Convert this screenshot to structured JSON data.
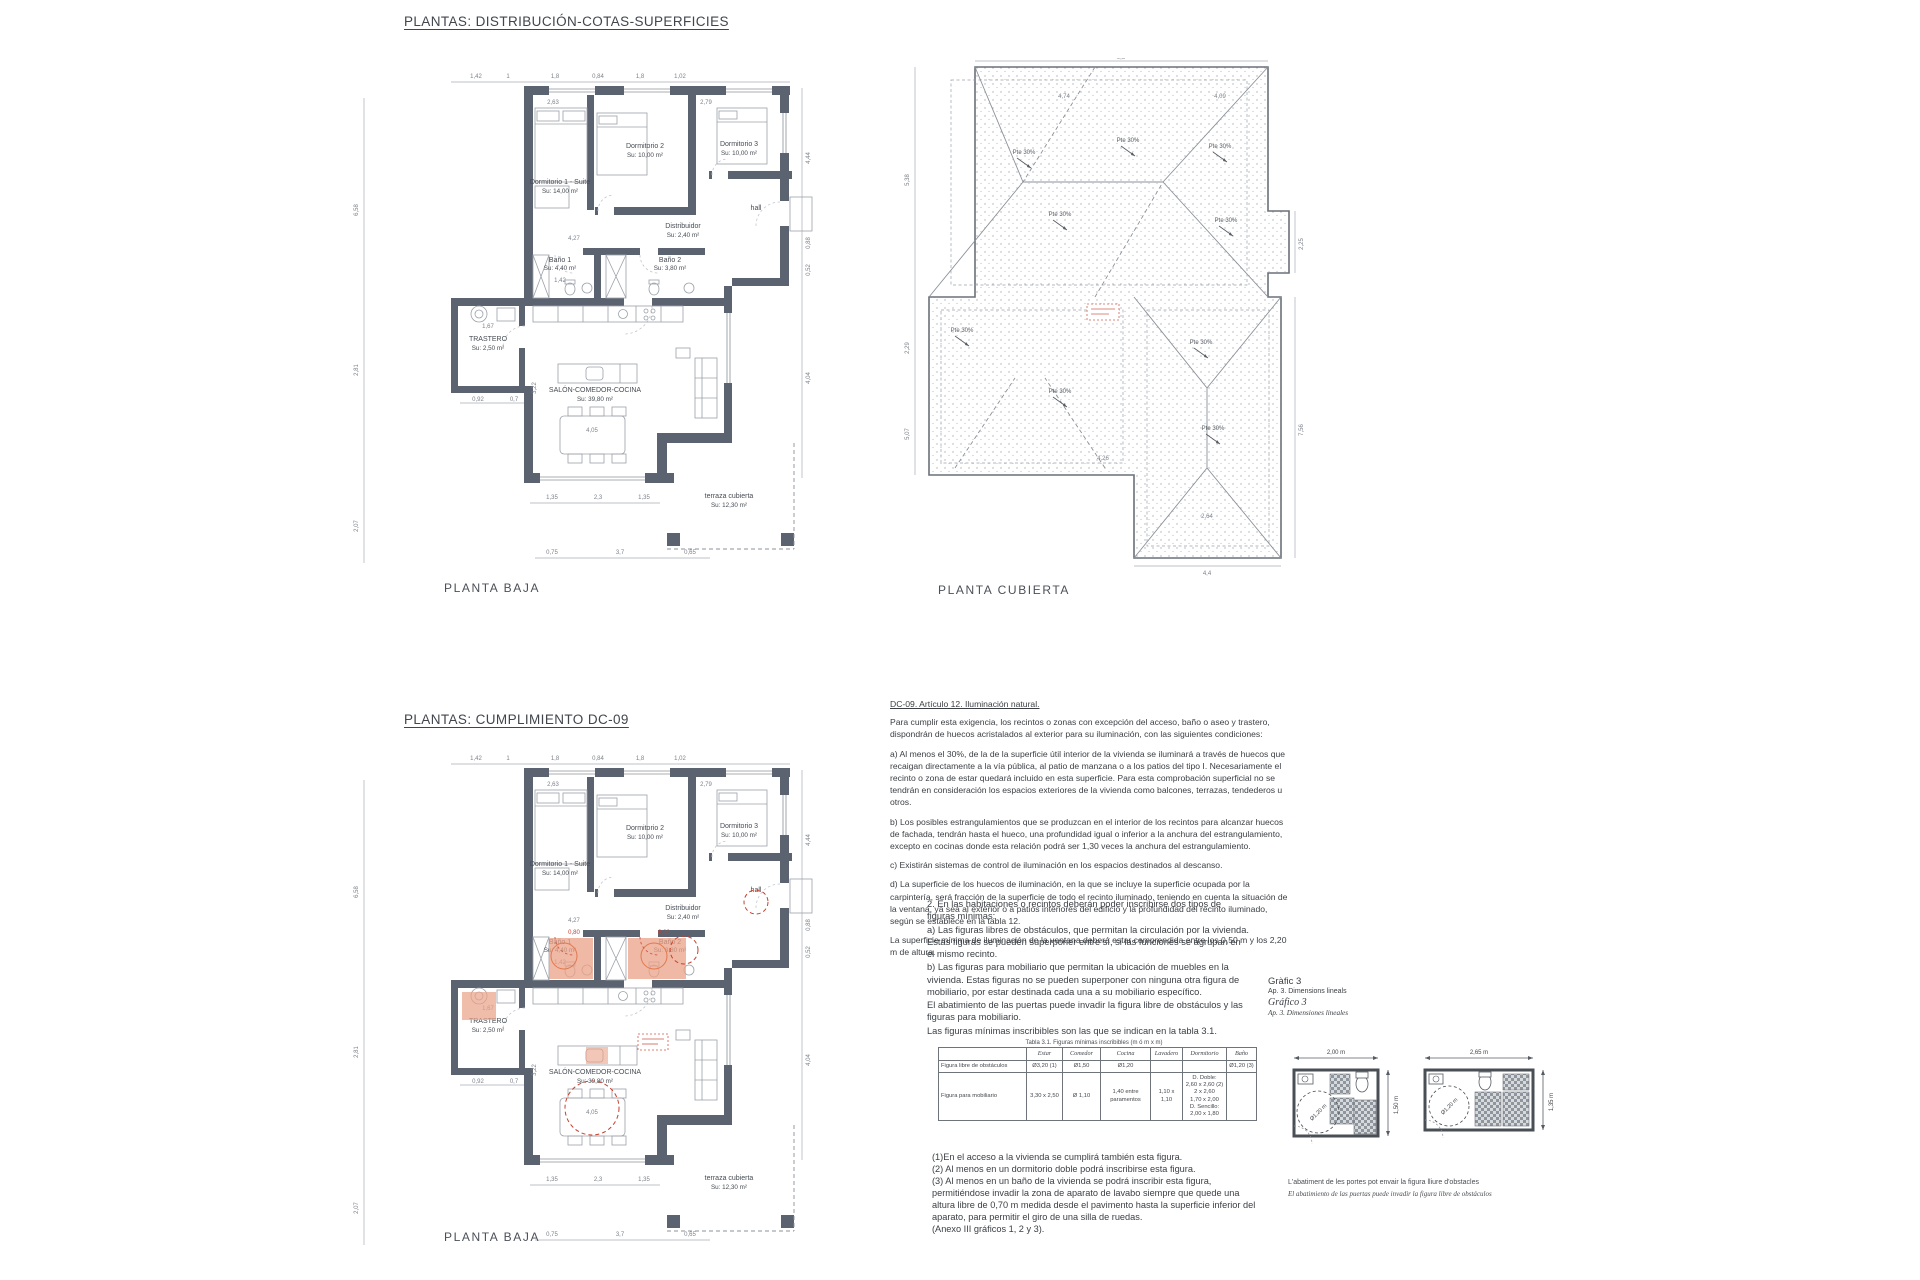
{
  "colors": {
    "wall": "#5b6370",
    "thin_line": "#9ba1a8",
    "dim_text": "#7c828a",
    "accent_salmon": "#eba187",
    "accent_red": "#c6402e",
    "roof_outline": "#6a717a"
  },
  "titles": {
    "distribution": "PLANTAS: DISTRIBUCIÓN-COTAS-SUPERFICIES",
    "compliance": "PLANTAS: CUMPLIMIENTO DC-09"
  },
  "captions": {
    "plan1": "PLANTA BAJA",
    "roof": "PLANTA CUBIERTA",
    "plan2": "PLANTA BAJA"
  },
  "rooms": {
    "d1": {
      "name": "Dormitorio 1 - Suite",
      "area": "Su: 14,00 m²"
    },
    "d2": {
      "name": "Dormitorio 2",
      "area": "Su: 10,00 m²"
    },
    "d3": {
      "name": "Dormitorio 3",
      "area": "Su: 10,00 m²"
    },
    "dist": {
      "name": "Distribuidor",
      "area": "Su: 2,40 m²"
    },
    "b1": {
      "name": "Baño 1",
      "area": "Su: 4,40 m²"
    },
    "b2": {
      "name": "Baño 2",
      "area": "Su: 3,80 m²"
    },
    "hall": {
      "name": "hall"
    },
    "tras": {
      "name": "TRASTERO",
      "area": "Su: 2,50 m²"
    },
    "salon": {
      "name": "SALÓN-COMEDOR-COCINA",
      "area": "Su: 39,80 m²"
    },
    "terraza": {
      "name": "terraza cubierta",
      "area": "Su: 12,30 m²"
    }
  },
  "plan_dims": {
    "top": [
      "1,42",
      "1",
      "1,8",
      "0,84",
      "1,8",
      "1,02"
    ],
    "left": [
      "6,58",
      "2,81",
      "2,07"
    ],
    "right": [
      "4,44",
      "0,88",
      "0,52",
      "4,04"
    ],
    "inner": [
      "2,63",
      "2,79",
      "4,27",
      "1,42",
      "1,67",
      "4,05",
      "3,22"
    ],
    "trastero_under": [
      "0,92",
      "0,7"
    ],
    "bottom": [
      "1,35",
      "2,3",
      "1,35"
    ],
    "bottom2": [
      "0,75",
      "3,7",
      "0,65"
    ]
  },
  "plan2": {
    "door_clearance_1": "0,80",
    "door_clearance_2": "0,80"
  },
  "roof_plan": {
    "slope_label": "Pte 30%",
    "dims": {
      "top": "9,8",
      "right_upper": "2,25",
      "right_lower": "7,56",
      "left_upper": "5,38",
      "left_mid": "2,29",
      "left_lower": "5,07",
      "bottom": "4,4",
      "inner_left": "4,74",
      "inner_right": "4,09",
      "inner_bottom": "4,26",
      "inner_bottom2": "2,64"
    }
  },
  "regulation": {
    "title": "DC-09. Artículo 12. Iluminación natural.",
    "p1": "Para cumplir esta exigencia, los recintos o zonas con excepción del acceso, baño o aseo y trastero, dispondrán de huecos acristalados al exterior para su iluminación, con las siguientes condiciones:",
    "p2": "a) Al menos el 30%, de la de la superficie útil interior de la vivienda se iluminará a través de huecos que recaigan directamente a la vía pública, al patio de manzana o a los patios del tipo I. Necesariamente el recinto o zona de estar quedará incluido en esta superficie. Para esta comprobación superficial no se tendrán en consideración los espacios exteriores de la vivienda como balcones, terrazas, tendederos u otros.",
    "p3": "b) Los posibles estrangulamientos que se produzcan en el interior de los recintos para alcanzar huecos de fachada, tendrán hasta el hueco, una profundidad igual o inferior a la anchura del estrangulamiento, excepto en cocinas donde esta relación podrá ser 1,30 veces la anchura del estrangulamiento.",
    "p4": "c) Existirán sistemas de control de iluminación en los espacios destinados al descanso.",
    "p5": "d) La superficie de los huecos de iluminación, en la que se incluye la superficie ocupada por la carpintería, será fracción de la superficie de todo el recinto iluminado, teniendo en cuenta la situación de la ventana, ya sea al exterior o a patios interiores del edificio y la profundidad del recinto iluminado, según se establece en la tabla 12.",
    "p6": "La superficie mínima de iluminación de la ventana deberá estar comprendida entre los 0,50 m y los 2,20 m de altura."
  },
  "figures_rules": {
    "intro": "2. En las habitaciones o recintos deberán poder inscribirse dos tipos de figuras mínimas:",
    "item_a": "a) Las figuras libres de obstáculos, que permitan la circulación por la vivienda. Estas figuras se pueden superponer entre sí, si las funciones se agrupan en el mismo recinto.",
    "item_b": "b) Las figuras para mobiliario que permitan la ubicación de muebles en la vivienda. Estas figuras no se pueden superponer con ninguna otra figura de mobiliario, por estar destinada cada una a su mobiliario específico.",
    "note1": "El abatimiento de las puertas puede invadir la figura libre de obstáculos y las figuras para mobiliario.",
    "note2": "Las figuras mínimas inscribibles son las que se indican en la tabla 3.1."
  },
  "table": {
    "title": "Tabla 3.1. Figuras mínimas inscribibles (m ó m x m)",
    "columns": [
      "Estar",
      "Comedor",
      "Cocina",
      "Lavadero",
      "Dormitorio",
      "Baño"
    ],
    "row_header_1": "Figura libre de obstáculos",
    "row1": [
      "Ø3,20 (1)",
      "Ø1,50",
      "Ø1,20",
      "",
      "",
      "Ø1,20 (3)"
    ],
    "row_header_2": "Figura para mobiliario",
    "row2": [
      "3,30 x 2,50",
      "Ø 1,10",
      "1,40 entre paramentos",
      "1,10 x 1,10",
      "D. Doble:\n2,60 x 2,60 (2)\n2 x 2,60\n1,70 x 2,00\nD. Sencillo:\n2,00 x 1,80",
      ""
    ]
  },
  "footnotes": {
    "f1": "(1)En el acceso a la vivienda se cumplirá también esta figura.",
    "f2": "(2) Al menos en un dormitorio doble podrá inscribirse esta figura.",
    "f3": "(3) Al menos en un baño de la vivienda se podrá inscribir esta figura, permitiéndose invadir la zona de aparato de lavabo siempre que quede una altura libre de 0,70 m medida desde el pavimento hasta la superficie inferior del aparato, para permitir el giro de una silla de ruedas.",
    "f4": "(Anexo III gráficos 1, 2 y 3)."
  },
  "grafico3": {
    "title_va": "Gràfic 3",
    "subtitle_va": "Ap. 3. Dimensions lineals",
    "title_es": "Gráfico 3",
    "subtitle_es": "Ap. 3. Dimensiones lineales",
    "diag1": {
      "width": "2,00 m",
      "height": "1,50 m",
      "circle": "Ø1,20 m"
    },
    "diag2": {
      "width": "2,65 m",
      "height": "1,35 m",
      "circle": "Ø1,20 m"
    },
    "caption_va": "L'abatiment de les portes pot envair la figura lliure d'obstacles",
    "caption_es": "El abatimiento de las puertas puede invadir la figura libre de obstáculos"
  }
}
